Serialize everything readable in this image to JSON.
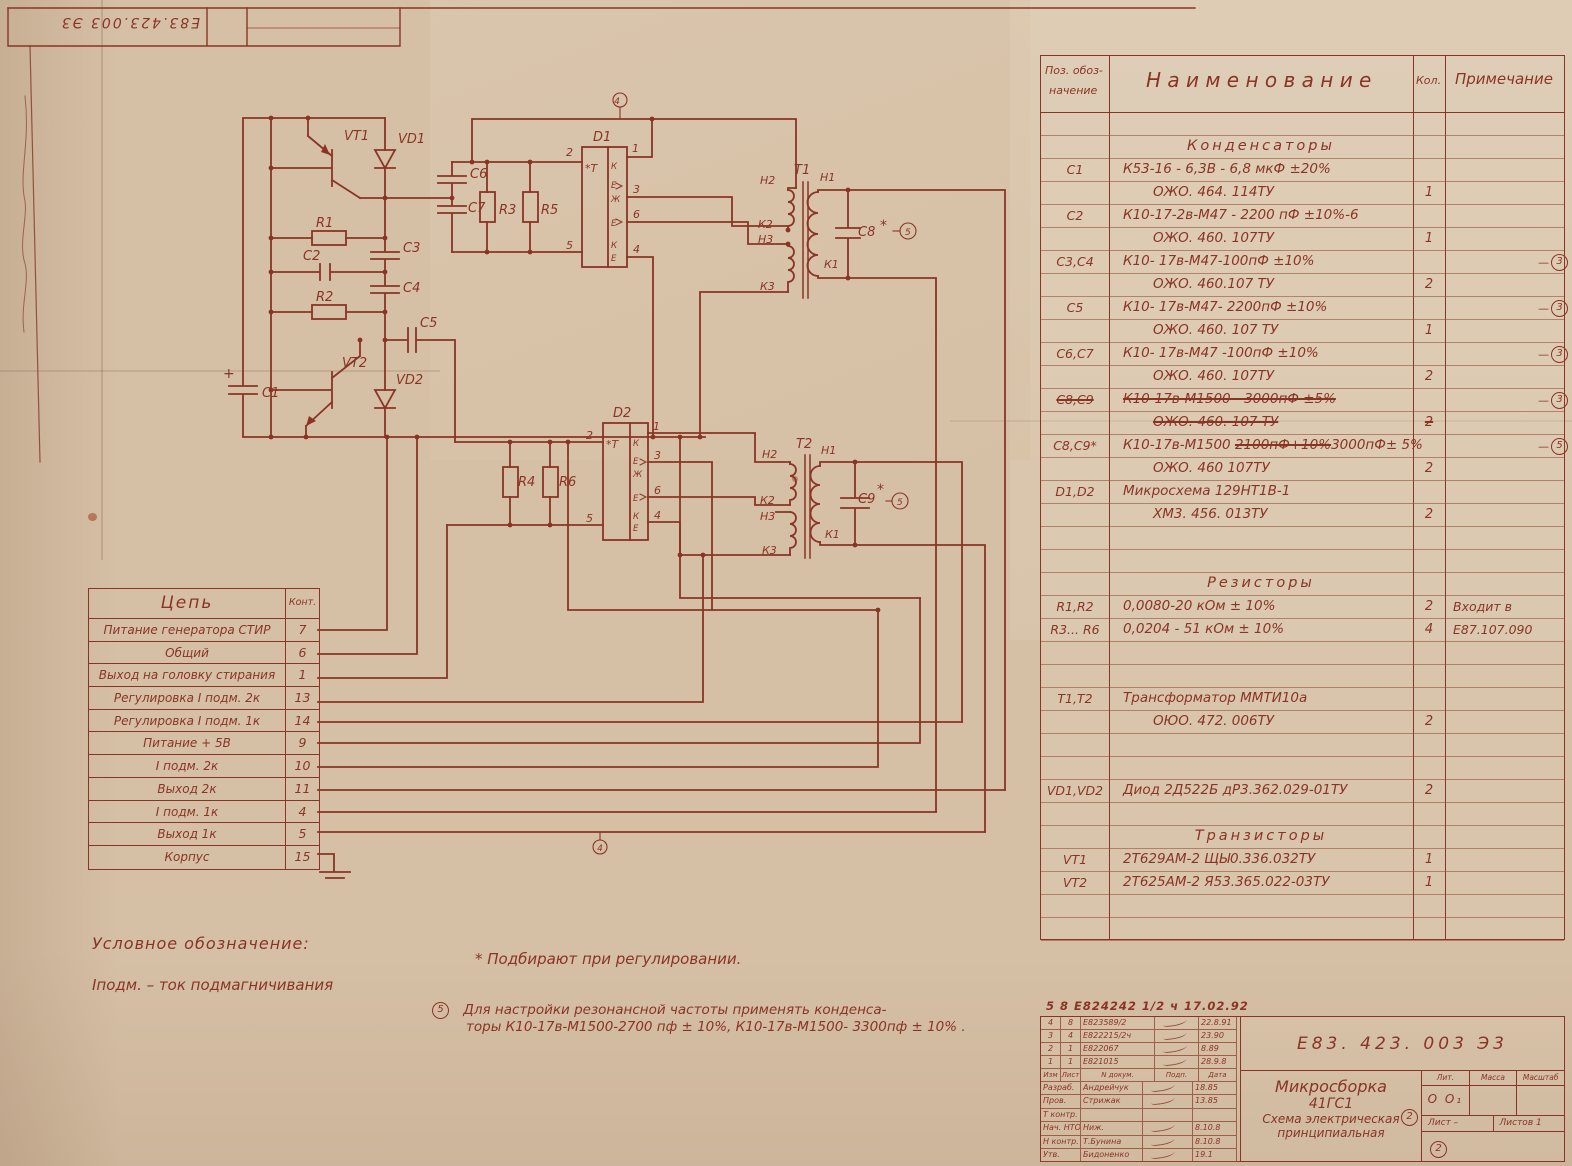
{
  "corner_stamp": {
    "doc_number": "Е83.423.003 Э3"
  },
  "schematic": {
    "labels": {
      "vt1": "VT1",
      "vt2": "VT2",
      "vd1": "VD1",
      "vd2": "VD2",
      "r1": "R1",
      "r2": "R2",
      "r3": "R3",
      "r4": "R4",
      "r5": "R5",
      "r6": "R6",
      "c1": "С1",
      "c2": "С2",
      "c3": "С3",
      "c4": "С4",
      "c5": "С5",
      "c6": "С6",
      "c7": "С7",
      "c8": "С8",
      "c9": "С9",
      "d1": "D1",
      "d2": "D2",
      "t1": "Т1",
      "t2": "Т2",
      "plus": "+",
      "star": "*",
      "ic_t": "*Т",
      "ic_k": "К",
      "ic_e": "Е",
      "ic_zh": "Ж",
      "w_h1": "Н1",
      "w_h2": "Н2",
      "w_h3": "Н3",
      "w_k1": "К1",
      "w_k2": "К2",
      "w_k3": "К3",
      "p1": "1",
      "p2": "2",
      "p3": "3",
      "p4": "4",
      "p5": "5",
      "p6": "6",
      "rev4": "4",
      "note5": "5"
    }
  },
  "pin_table": {
    "col_circuit": "Цепь",
    "col_pin": "Конт.",
    "rows": [
      [
        "Питание генератора СТИР",
        "7"
      ],
      [
        "Общий",
        "6"
      ],
      [
        "Выход на головку стирания",
        "1"
      ],
      [
        "Регулировка I подм.  2к",
        "13"
      ],
      [
        "Регулировка I подм.   1к",
        "14"
      ],
      [
        "Питание + 5В",
        "9"
      ],
      [
        "I подм.   2к",
        "10"
      ],
      [
        "Выход  2к",
        "11"
      ],
      [
        "I подм. 1к",
        "4"
      ],
      [
        "Выход 1к",
        "5"
      ],
      [
        "Корпус",
        "15"
      ]
    ]
  },
  "parts_table": {
    "h_pos1": "Поз. обоз-",
    "h_pos2": "начение",
    "h_name": "Н а и м е н о в а н и е",
    "h_qty": "Кол.",
    "h_note": "Примечание",
    "rows": [
      {},
      {
        "sec": "Конденсаторы"
      },
      {
        "pos": "С1",
        "name": "К53-16 - 6,3В - 6,8 мкФ ±20%"
      },
      {
        "name": "ОЖО. 464. 114ТУ",
        "qty": "1",
        "indent": 1
      },
      {
        "pos": "С2",
        "name": "К10-17-2в-М47 - 2200 пФ ±10%-6"
      },
      {
        "name": "ОЖО. 460. 107ТУ",
        "qty": "1",
        "indent": 1
      },
      {
        "pos": "С3,С4",
        "name": "К10-  17в-М47-100пФ ±10%",
        "circ": "3"
      },
      {
        "name": "ОЖО. 460.107 ТУ",
        "qty": "2",
        "indent": 1
      },
      {
        "pos": "С5",
        "name": "К10-  17в-М47- 2200пФ ±10%",
        "circ": "3"
      },
      {
        "name": "ОЖО. 460. 107 ТУ",
        "qty": "1",
        "indent": 1
      },
      {
        "pos": "С6,С7",
        "name": "К10- 17в-М47 -100пФ ±10%",
        "circ": "3"
      },
      {
        "name": "ОЖО. 460. 107ТУ",
        "qty": "2",
        "indent": 1
      },
      {
        "pos": "С8,С9",
        "name": "К10-17в-М1500 - 3000пФ ±5%",
        "circ": "3",
        "strike": 1
      },
      {
        "name": "ОЖО. 460. 107 ТУ",
        "qty": "2",
        "indent": 1,
        "strike": 1
      },
      {
        "pos": "С8,С9*",
        "circ": "5",
        "nameParts": [
          [
            "К10-17в-М1500 ",
            0
          ],
          [
            "2100пФ+10%",
            1
          ],
          [
            "3000пФ± 5%",
            0
          ]
        ]
      },
      {
        "name": "ОЖО. 460  107ТУ",
        "qty": "2",
        "indent": 1
      },
      {
        "pos": "D1,D2",
        "name": "Микросхема  129НТ1В-1"
      },
      {
        "name": "ХМ3. 456. 013ТУ",
        "qty": "2",
        "indent": 1
      },
      {},
      {},
      {
        "sec": "Резисторы"
      },
      {
        "pos": "R1,R2",
        "name": "0,0080-20 кОм ± 10%",
        "qty": "2",
        "note": "Входит в"
      },
      {
        "pos": "R3... R6",
        "name": "0,0204 - 51 кОм ±  10%",
        "qty": "4",
        "note": "Е87.107.090"
      },
      {},
      {},
      {
        "pos": "Т1,Т2",
        "name": "Трансформатор  ММТИ10а"
      },
      {
        "name": "ОЮО. 472. 006ТУ",
        "qty": "2",
        "indent": 1
      },
      {},
      {},
      {
        "pos": "VD1,VD2",
        "name": "Диод 2Д522Б  дР3.362.029-01ТУ",
        "qty": "2"
      },
      {},
      {
        "sec": "Транзисторы"
      },
      {
        "pos": "VT1",
        "name": "2Т629АМ-2   ЩЫ0.336.032ТУ",
        "qty": "1"
      },
      {
        "pos": "VT2",
        "name": "2Т625АМ-2  Я53.365.022-03ТУ",
        "qty": "1"
      },
      {},
      {}
    ]
  },
  "notes": {
    "legend1": "Условное  обозначение:",
    "legend2": "Iподм. –  ток  подмагничивания",
    "star_note": "*  Подбирают  при  регулировании.",
    "note5_mark": "5",
    "note5_line1": "Для  настройки резонансной  частоты  применять конденса-",
    "note5_line2": "торы К10-17в-М1500-2700 пф ± 10%, К10-17в-М1500- 3300пф ± 10% ."
  },
  "title_block": {
    "doc_number": "Е83. 423. 003 Э3",
    "product": "Микросборка",
    "product2": "41ГС1",
    "type1": "Схема электрическая",
    "type2": "принципиальная",
    "lit_label": "Лит.",
    "mass_label": "Масса",
    "scale_label": "Масштаб",
    "lit_value": "О О₁",
    "sheet_label": "Лист –",
    "sheets_label": "Листов  1",
    "circled2": "2",
    "rev_note": "5 8   Е824242 1/2 ч   17.02.92",
    "rev_headers": [
      "Изм",
      "Лист",
      "N докум.",
      "Подп.",
      "Дата"
    ],
    "rev_rows": [
      [
        "4",
        "8",
        "Е823589/2",
        "22.8.91"
      ],
      [
        "3",
        "4",
        "Е822215/2ч",
        "23.90"
      ],
      [
        "2",
        "1",
        "Е822067",
        "8.89"
      ],
      [
        "1",
        "1",
        "Е821015",
        "28.9.8"
      ]
    ],
    "sign_rows": [
      [
        "Разраб.",
        "Андрейчук",
        "18.85"
      ],
      [
        "Пров.",
        "Стрижак",
        "13.85"
      ],
      [
        "Т контр.",
        "",
        ""
      ],
      [
        "Нач. НТО",
        "Ниж.",
        "8.10.8"
      ],
      [
        "Н контр.",
        "Т.Бунина",
        "8.10.8"
      ],
      [
        "Утв.",
        "Бидоненко",
        "19.1"
      ]
    ]
  }
}
